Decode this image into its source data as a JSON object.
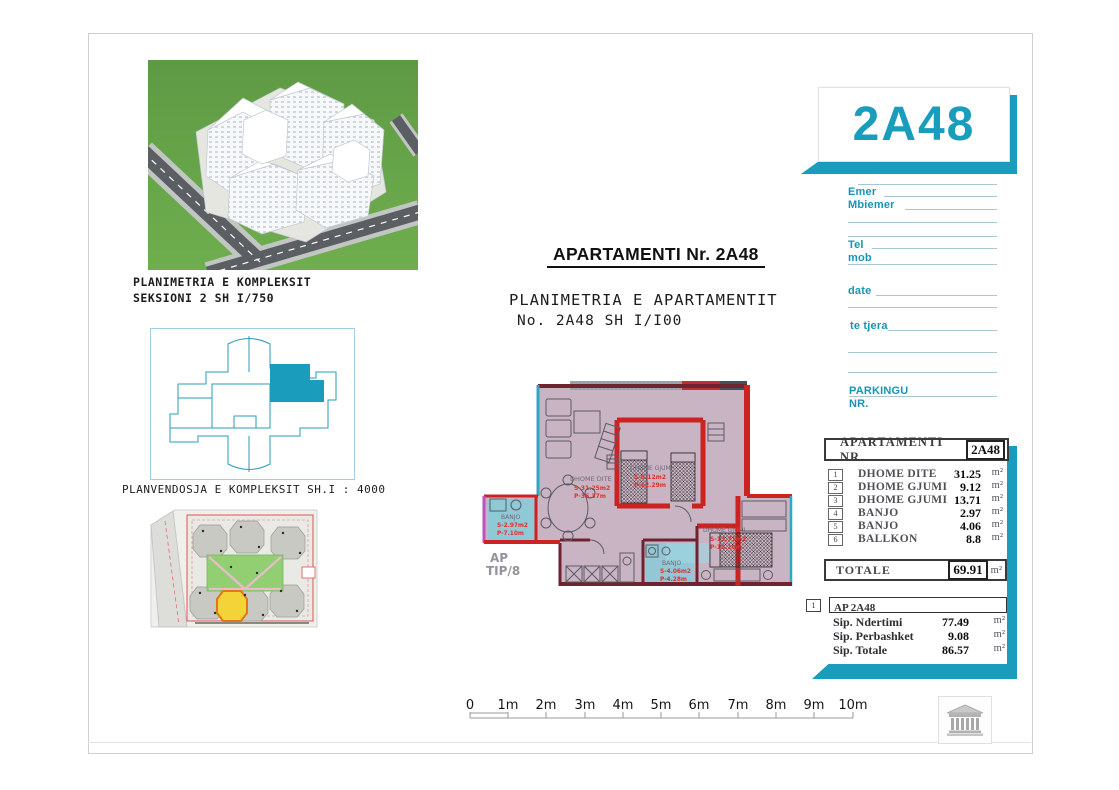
{
  "document": {
    "captions": {
      "complex_plan_line1": "PLANIMETRIA E KOMPLEKSIT",
      "complex_plan_line2": "SEKSIONI 2   SH I/750",
      "site_plan": "PLANVENDOSJA E KOMPLEKSIT SH.I : 4000"
    },
    "title": "APARTAMENTI Nr. 2A48",
    "subtitle_line1": "PLANIMETRIA E APARTAMENTIT",
    "subtitle_line2": "No. 2A48 SH I/I00"
  },
  "floorplan": {
    "ap_type_line1": "AP",
    "ap_type_line2": "TIP/8",
    "rooms": [
      {
        "name": "DHOME DITE",
        "area": "S-31.25m2",
        "perimeter": "P-36.37m"
      },
      {
        "name": "DHOME GJUMI",
        "area": "S-9.12m2",
        "perimeter": "P-12.29m"
      },
      {
        "name": "DHOME GJUMI",
        "area": "S-13.71m2",
        "perimeter": "P-15.10m"
      },
      {
        "name": "BANJO",
        "area": "S-2.97m2",
        "perimeter": "P-7.10m"
      },
      {
        "name": "BANJO",
        "area": "S-4.06m2",
        "perimeter": "P-4.28m"
      }
    ]
  },
  "panel": {
    "unit_code": "2A48",
    "form": {
      "labels": [
        "Emer",
        "Mbiemer",
        "Tel",
        "mob",
        "date",
        "te tjera",
        "PARKINGU",
        "NR."
      ]
    },
    "area_table": {
      "header": "APARTAMENTI  NR.",
      "header_unit": "2A48",
      "rows": [
        {
          "no": "1",
          "name": "DHOME DITE",
          "value": "31.25",
          "unit": "m²"
        },
        {
          "no": "2",
          "name": "DHOME GJUMI",
          "value": "9.12",
          "unit": "m²"
        },
        {
          "no": "3",
          "name": "DHOME GJUMI",
          "value": "13.71",
          "unit": "m²"
        },
        {
          "no": "4",
          "name": "BANJO",
          "value": "2.97",
          "unit": "m²"
        },
        {
          "no": "5",
          "name": "BANJO",
          "value": "4.06",
          "unit": "m²"
        },
        {
          "no": "6",
          "name": "BALLKON",
          "value": "8.8",
          "unit": "m²"
        }
      ],
      "total_label": "TOTALE",
      "total_value": "69.91",
      "total_unit": "m²"
    },
    "summary": {
      "index": "1",
      "header": "AP 2A48",
      "rows": [
        {
          "name": "Sip. Ndertimi",
          "value": "77.49",
          "unit": "m²"
        },
        {
          "name": "Sip. Perbashket",
          "value": "9.08",
          "unit": "m²"
        },
        {
          "name": "Sip. Totale",
          "value": "86.57",
          "unit": "m²"
        }
      ]
    }
  },
  "scalebar": {
    "labels": [
      "0",
      "1m",
      "2m",
      "3m",
      "4m",
      "5m",
      "6m",
      "7m",
      "8m",
      "9m",
      "10m"
    ]
  },
  "colors": {
    "accent": "#1a9cbd",
    "wall_red": "#cc2222",
    "wall_dark": "#6e2430",
    "plan_fill": "#c9b4c4",
    "bath_floor": "#86ccd9",
    "label_red": "#e0312f"
  }
}
